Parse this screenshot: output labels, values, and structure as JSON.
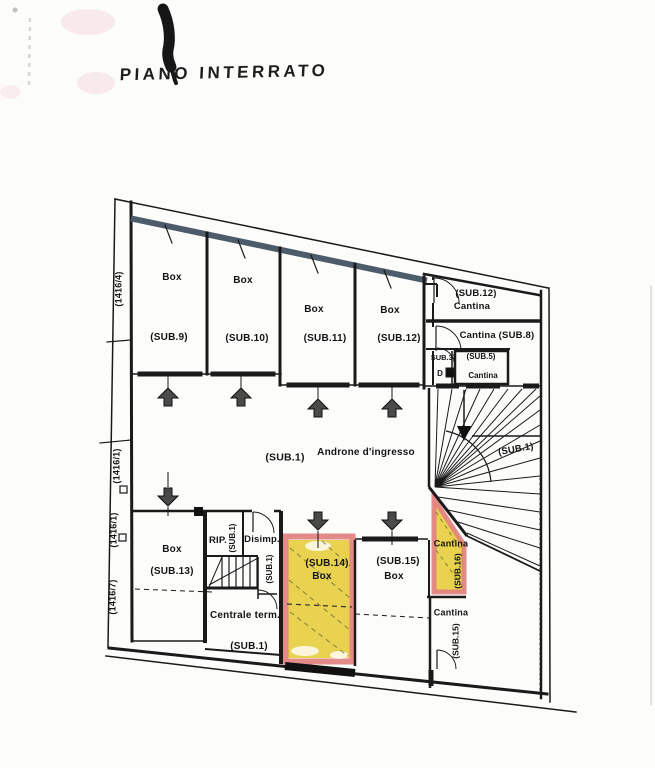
{
  "document": {
    "title": "PIANO INTERRATO",
    "floor_type": "basement plan"
  },
  "parcels": {
    "p1": "(1416/4)",
    "p2": "(1416/1)",
    "p3": "(1416/1)",
    "p4": "(1416/7)"
  },
  "rooms": {
    "box9": {
      "name": "Box",
      "sub": "(SUB.9)"
    },
    "box10": {
      "name": "Box",
      "sub": "(SUB.10)"
    },
    "box11": {
      "name": "Box",
      "sub": "(SUB.11)"
    },
    "box12": {
      "name": "Box",
      "sub": "(SUB.12)"
    },
    "cantina12": {
      "sub": "(SUB.12)",
      "name": "Cantina"
    },
    "cantina8": {
      "name": "Cantina  (SUB.8)"
    },
    "sub3": {
      "sub": "SUB.3)"
    },
    "sub5": {
      "sub": "(SUB.5)",
      "name": "Cantina"
    },
    "dis": {
      "name": "D"
    },
    "androne": {
      "sub": "(SUB.1)",
      "name": "Androne d'ingresso"
    },
    "stairs": {
      "sub": "(SUB.1)"
    },
    "box13": {
      "name": "Box",
      "sub": "(SUB.13)"
    },
    "rip": {
      "name": "RIP.",
      "sub": "(SUB.1)"
    },
    "disimp": {
      "name": "Disimp.",
      "sub": "(SUB.1)"
    },
    "centrale": {
      "name": "Centrale term.",
      "sub": "(SUB.1)"
    },
    "box14": {
      "sub": "(SUB.14)",
      "name": "Box"
    },
    "box15": {
      "sub": "(SUB.15)",
      "name": "Box"
    },
    "cantina16": {
      "name": "Cantina",
      "sub": "(SUB.16)"
    },
    "cantina15": {
      "name": "Cantina",
      "sub": "(SUB.15)"
    }
  },
  "colors": {
    "highlight_yellow": "#e8d24f",
    "highlight_pink": "#e2807f",
    "wall_black": "#1a1a1a",
    "wall_band_blue": "#4d5c6b",
    "paper": "#fcfcfb"
  }
}
